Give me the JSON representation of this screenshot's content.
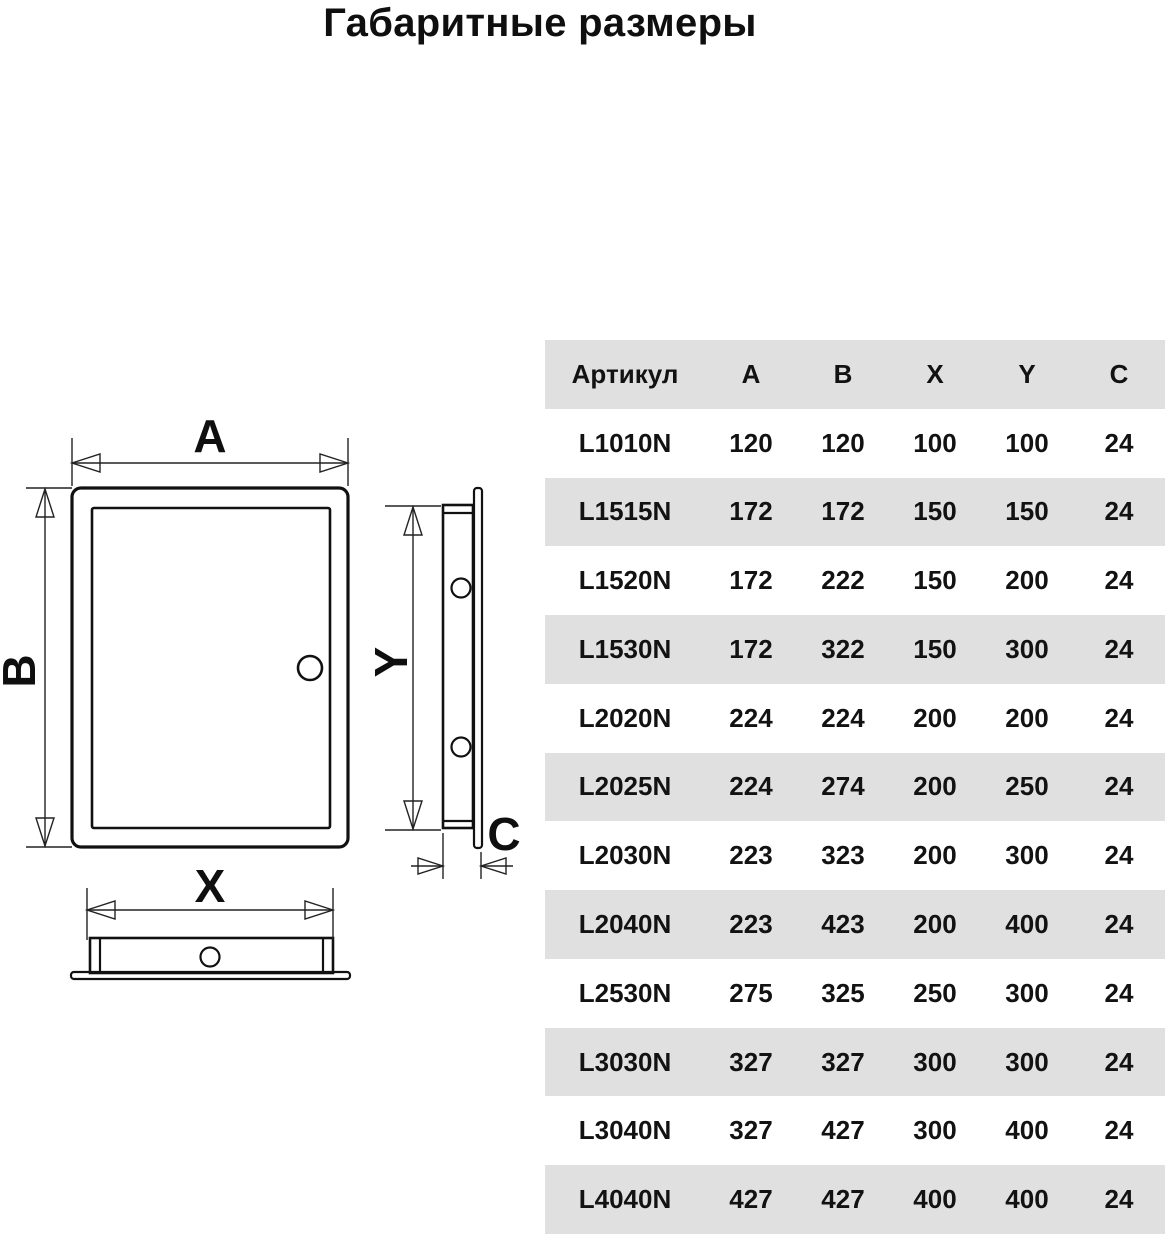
{
  "title": "Габаритные размеры",
  "diagram": {
    "labels": {
      "a": "A",
      "b": "B",
      "x": "X",
      "y": "Y",
      "c": "C"
    }
  },
  "table": {
    "columns": [
      "Артикул",
      "A",
      "B",
      "X",
      "Y",
      "C"
    ],
    "rows": [
      {
        "article": "L1010N",
        "a": "120",
        "b": "120",
        "x": "100",
        "y": "100",
        "c": "24"
      },
      {
        "article": "L1515N",
        "a": "172",
        "b": "172",
        "x": "150",
        "y": "150",
        "c": "24"
      },
      {
        "article": "L1520N",
        "a": "172",
        "b": "222",
        "x": "150",
        "y": "200",
        "c": "24"
      },
      {
        "article": "L1530N",
        "a": "172",
        "b": "322",
        "x": "150",
        "y": "300",
        "c": "24"
      },
      {
        "article": "L2020N",
        "a": "224",
        "b": "224",
        "x": "200",
        "y": "200",
        "c": "24"
      },
      {
        "article": "L2025N",
        "a": "224",
        "b": "274",
        "x": "200",
        "y": "250",
        "c": "24"
      },
      {
        "article": "L2030N",
        "a": "223",
        "b": "323",
        "x": "200",
        "y": "300",
        "c": "24"
      },
      {
        "article": "L2040N",
        "a": "223",
        "b": "423",
        "x": "200",
        "y": "400",
        "c": "24"
      },
      {
        "article": "L2530N",
        "a": "275",
        "b": "325",
        "x": "250",
        "y": "300",
        "c": "24"
      },
      {
        "article": "L3030N",
        "a": "327",
        "b": "327",
        "x": "300",
        "y": "300",
        "c": "24"
      },
      {
        "article": "L3040N",
        "a": "327",
        "b": "427",
        "x": "300",
        "y": "400",
        "c": "24"
      },
      {
        "article": "L4040N",
        "a": "427",
        "b": "427",
        "x": "400",
        "y": "400",
        "c": "24"
      }
    ]
  },
  "colors": {
    "row_alt": "#e0e0e0",
    "ink": "#111111"
  }
}
